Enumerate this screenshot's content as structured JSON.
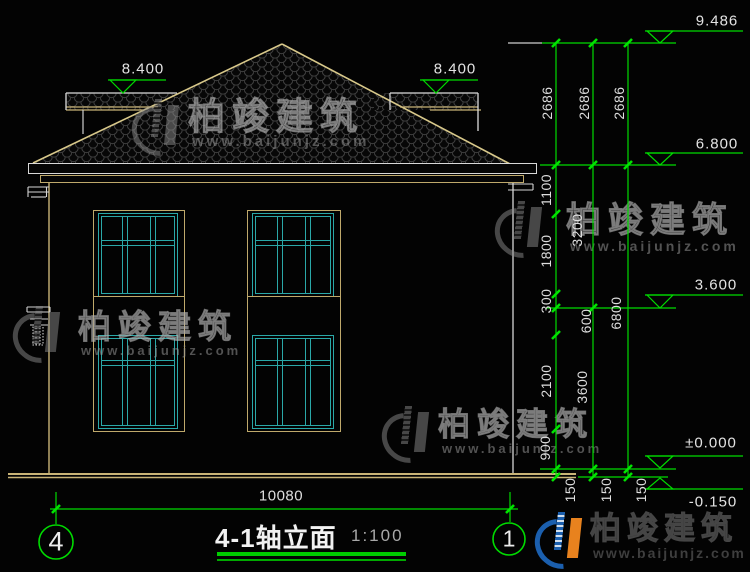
{
  "drawing": {
    "title": "4-1轴立面",
    "scale": "1:100",
    "axis_left": "4",
    "axis_right": "1",
    "width_total": "10080"
  },
  "levels": {
    "ridge": "9.486",
    "parapet": "8.400",
    "eave": "6.800",
    "floor2": "3.600",
    "floor1": "±0.000",
    "ground": "-0.150"
  },
  "dims": {
    "story_a": "2686",
    "story_b": "2686",
    "story_c": "2686",
    "eave_drop": "1100",
    "win2_h": "1800",
    "sill_gap": "300",
    "belt": "600",
    "win1_h": "2100",
    "sill1": "900",
    "floor2_h": "3200",
    "floor1_h": "3600",
    "total_h": "6800",
    "plinth_a": "150",
    "plinth_b": "150",
    "plinth_c": "150"
  },
  "watermark": {
    "brand": "柏竣建筑",
    "url": "www.baijunjz.com"
  },
  "colors": {
    "annotation_green": "#00DB00",
    "outline_tan": "#C9B477",
    "window_cyan": "#2AA8A8",
    "dim_text": "#DEDEDE",
    "logo_blue": "#1B5FAE",
    "logo_orange": "#E8821E"
  }
}
